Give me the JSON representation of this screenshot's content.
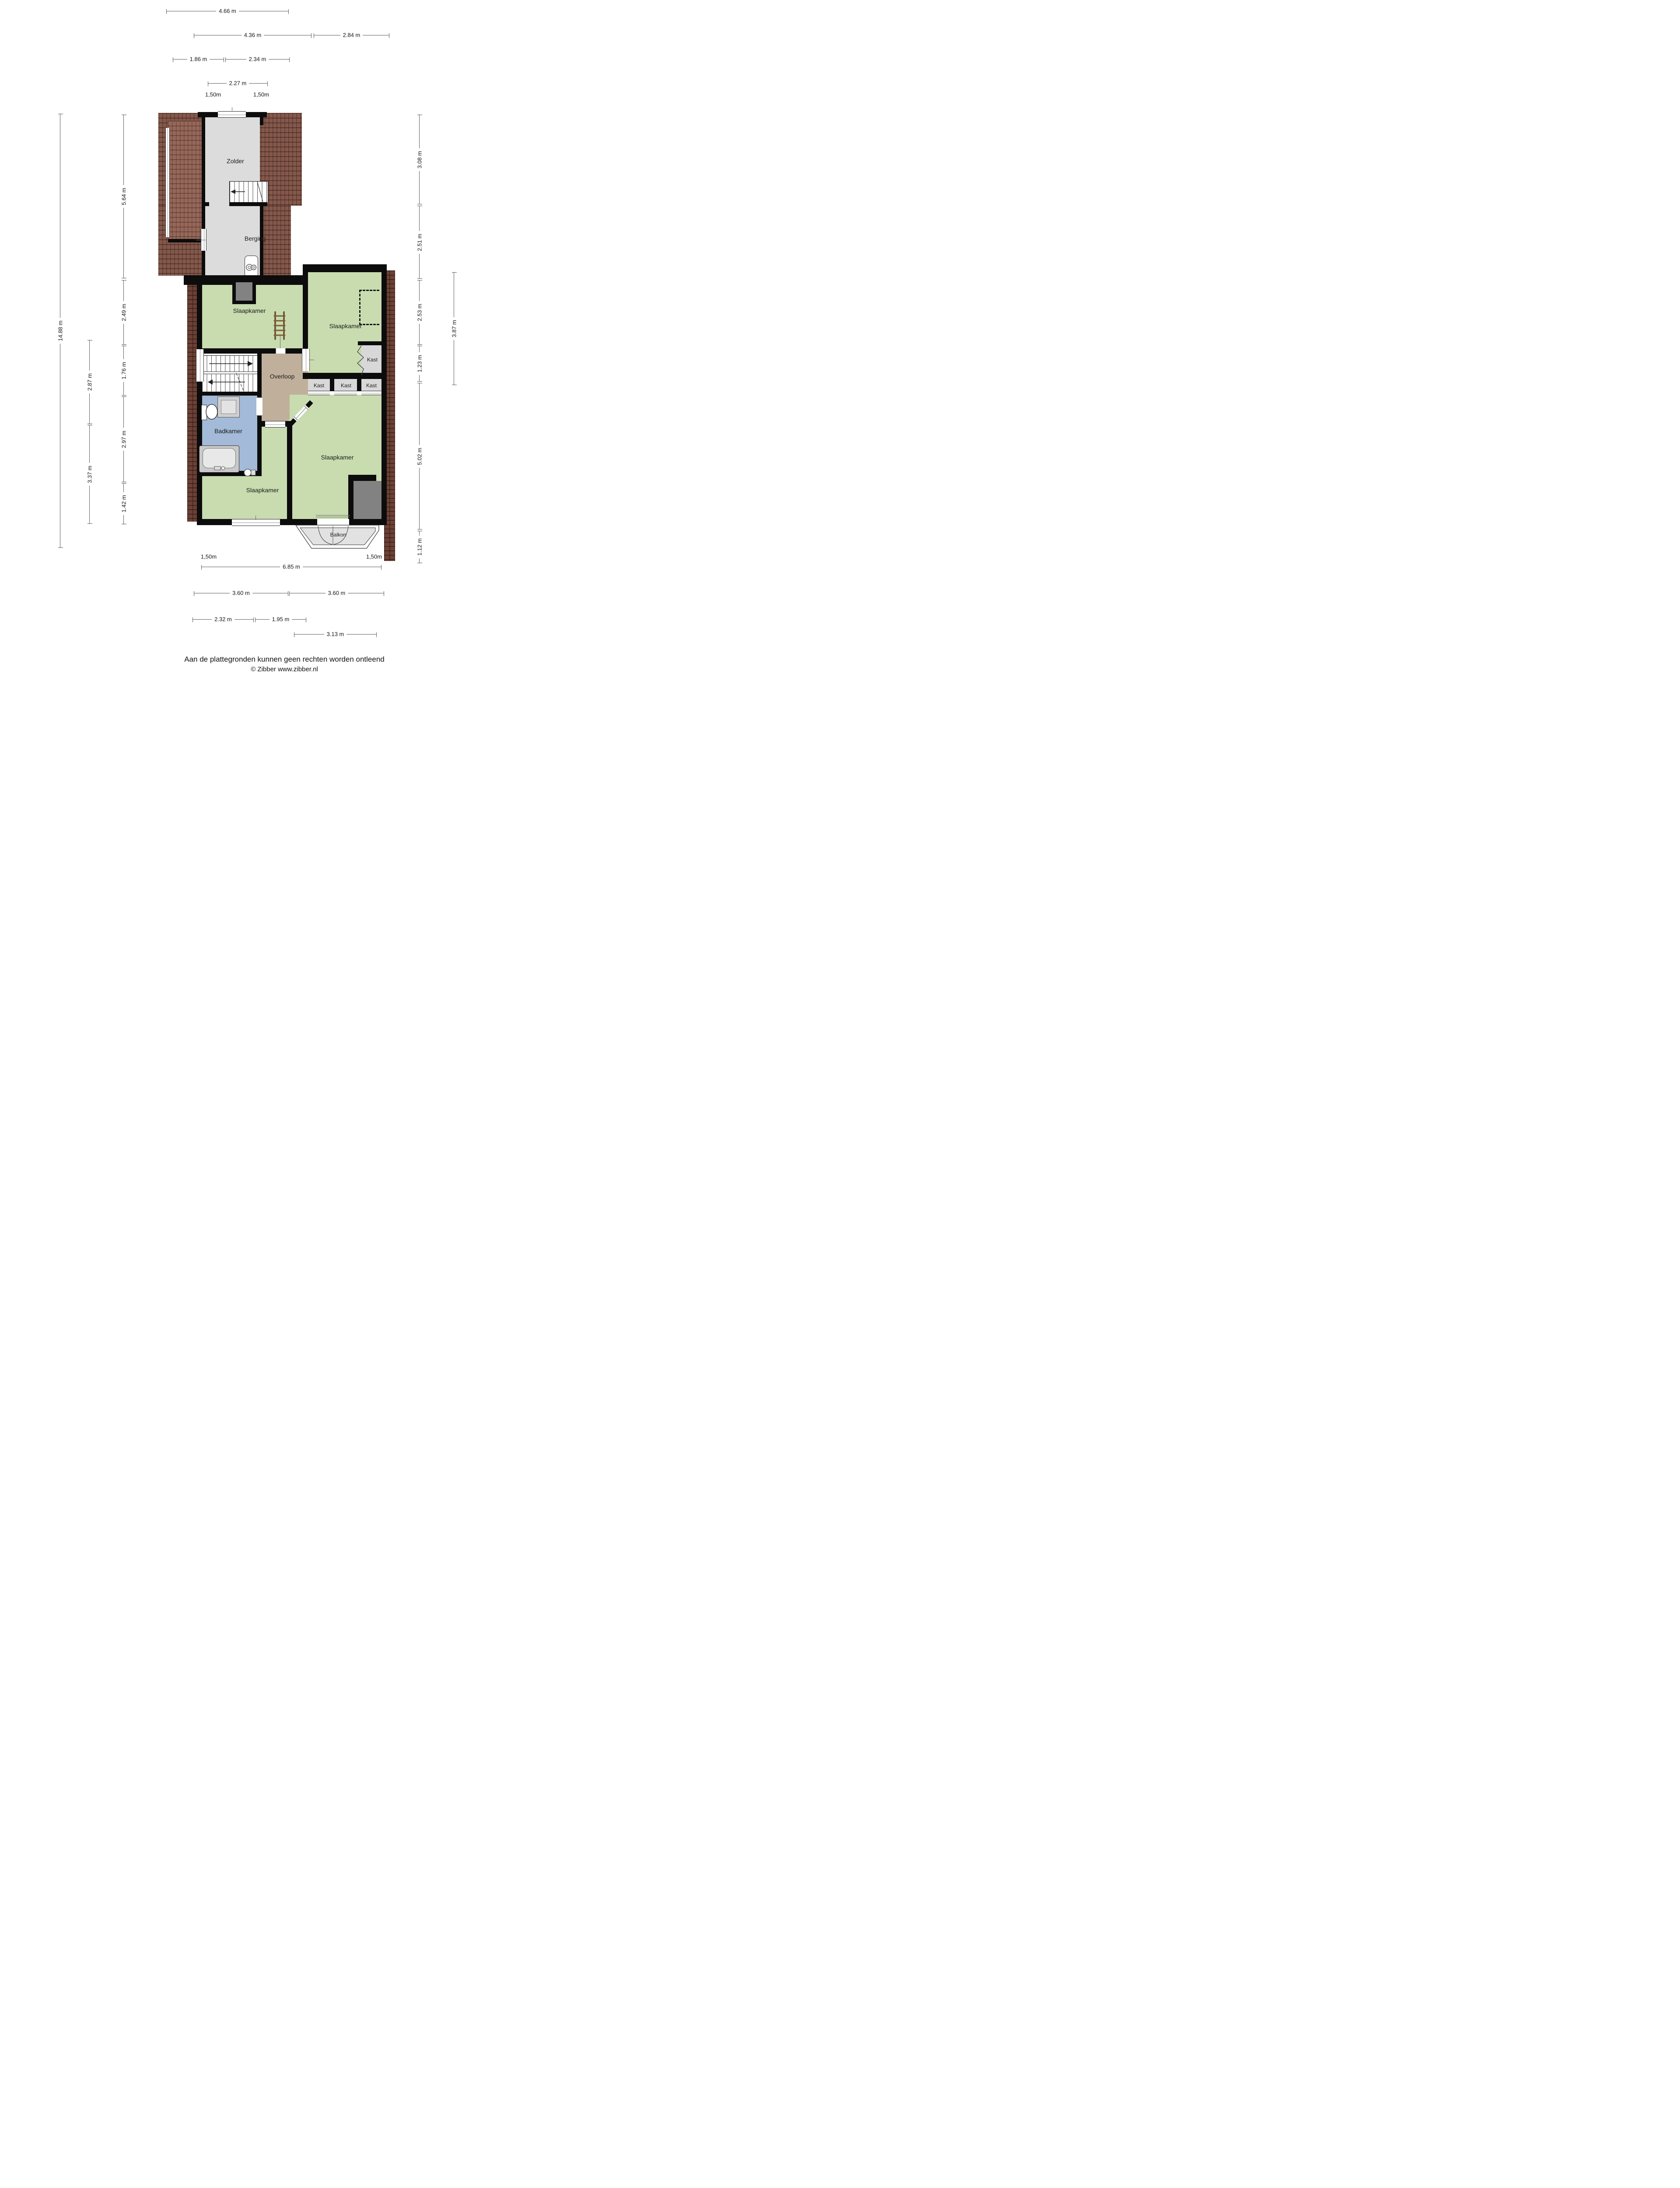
{
  "page": {
    "footer_disclaimer": "Aan de plattegronden kunnen geen rechten worden ontleend",
    "footer_copyright": "© Zibber www.zibber.nl"
  },
  "rooms": {
    "zolder": "Zolder",
    "berging": "Berging",
    "slaapkamer_1": "Slaapkamer",
    "slaapkamer_2": "Slaapkamer",
    "slaapkamer_3": "Slaapkamer",
    "slaapkamer_4": "Slaapkamer",
    "overloop": "Overloop",
    "badkamer": "Badkamer",
    "kast_1": "Kast",
    "kast_2": "Kast",
    "kast_3": "Kast",
    "kast_4": "Kast",
    "balkon": "Balkon"
  },
  "dimensions": {
    "top": [
      {
        "label": "4.66 m"
      },
      {
        "label": "4.36 m"
      },
      {
        "label": "2.84 m"
      },
      {
        "label": "1.86 m"
      },
      {
        "label": "2.34 m"
      },
      {
        "label": "2.27 m"
      },
      {
        "label": "1,50m"
      },
      {
        "label": "1,50m"
      }
    ],
    "left": [
      {
        "label": "14.88 m"
      },
      {
        "label": "5.64 m"
      },
      {
        "label": "2.49 m"
      },
      {
        "label": "1.76 m"
      },
      {
        "label": "2.97 m"
      },
      {
        "label": "1.42 m"
      },
      {
        "label": "2.87 m"
      },
      {
        "label": "3.37 m"
      }
    ],
    "right": [
      {
        "label": "3.08 m"
      },
      {
        "label": "2.51 m"
      },
      {
        "label": "2.53 m"
      },
      {
        "label": "1.23 m"
      },
      {
        "label": "5.02 m"
      },
      {
        "label": "1.12 m"
      },
      {
        "label": "3.87 m"
      }
    ],
    "bottom": [
      {
        "label": "1,50m"
      },
      {
        "label": "1,50m"
      },
      {
        "label": "6.85 m"
      },
      {
        "label": "3.60 m"
      },
      {
        "label": "3.60 m"
      },
      {
        "label": "2.32 m"
      },
      {
        "label": "1.95 m"
      },
      {
        "label": "3.13 m"
      }
    ]
  },
  "colors": {
    "roof": "#84584b",
    "roof_band": "#6d4136",
    "attic_floor": "#dcdcdc",
    "room_green": "#c8dcb0",
    "landing_tan": "#c0b09b",
    "bathroom_blue": "#a3bad8",
    "closet_gray": "#d8d8d8",
    "chimney_gray": "#828282",
    "balcony_gray": "#e2e2e2",
    "wall": "#0c0c0c"
  }
}
